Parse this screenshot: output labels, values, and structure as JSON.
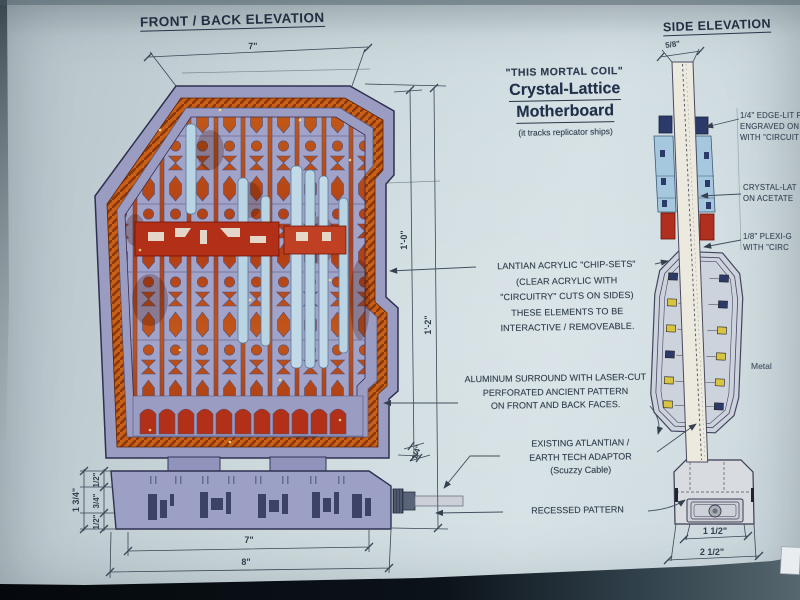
{
  "titles": {
    "front": "FRONT / BACK ELEVATION",
    "side": "SIDE ELEVATION"
  },
  "title_block": {
    "episode": "\"THIS MORTAL COIL\"",
    "name1": "Crystal-Lattice",
    "name2": "Motherboard",
    "tagline": "(it tracks replicator ships)"
  },
  "annotations": {
    "chip_sets": {
      "l1": "LANTIAN ACRYLIC \"CHIP-SETS\"",
      "l2": "(CLEAR ACRYLIC WITH",
      "l3": "\"CIRCUITRY\" CUTS ON SIDES)",
      "l4": "THESE ELEMENTS TO BE",
      "l5": "INTERACTIVE / REMOVEABLE."
    },
    "surround": {
      "l1": "ALUMINUM SURROUND WITH LASER-CUT",
      "l2": "PERFORATED ANCIENT PATTERN",
      "l3": "ON FRONT AND BACK FACES."
    },
    "adaptor": {
      "l1": "EXISTING ATLANTIAN /",
      "l2": "EARTH TECH ADAPTOR",
      "l3": "(Scuzzy Cable)"
    },
    "recessed": {
      "l1": "RECESSED PATTERN"
    },
    "edge_lit": {
      "l1": "1/4\" EDGE-LIT P",
      "l2": "ENGRAVED ON",
      "l3": "WITH \"CIRCUIT"
    },
    "crystal": {
      "l1": "CRYSTAL-LAT",
      "l2": "ON ACETATE"
    },
    "plexi": {
      "l1": "1/8\" PLEXI-G",
      "l2": "WITH \"CIRC"
    },
    "metal": {
      "l1": "Metal"
    }
  },
  "dimensions": {
    "front": {
      "top_width": "7\"",
      "body_height": "1'-0\"",
      "total_height": "1'-2\"",
      "base_stack_total": "1 3/4\"",
      "base_seg_top": "1/2\"",
      "base_seg_mid": "3/4\"",
      "base_seg_bot": "1/2\"",
      "adaptor_thickness": "1/4\"",
      "bottom_width": "7\"",
      "base_width": "8\""
    },
    "side": {
      "top_width": "5/8\"",
      "recess_width": "1 1/2\"",
      "base_width": "2 1/2\""
    }
  },
  "colors": {
    "paper": "#cfdde1",
    "ink": "#33404e",
    "surround_lavender": "#9a9cc2",
    "pattern_orange": "#c65a1e",
    "band_red": "#b23018",
    "plexi_blue": "#b9d4e2",
    "chip_yellow": "#d8c440",
    "chip_navy": "#2c3a6a",
    "photo_dark": "#0c1116"
  }
}
